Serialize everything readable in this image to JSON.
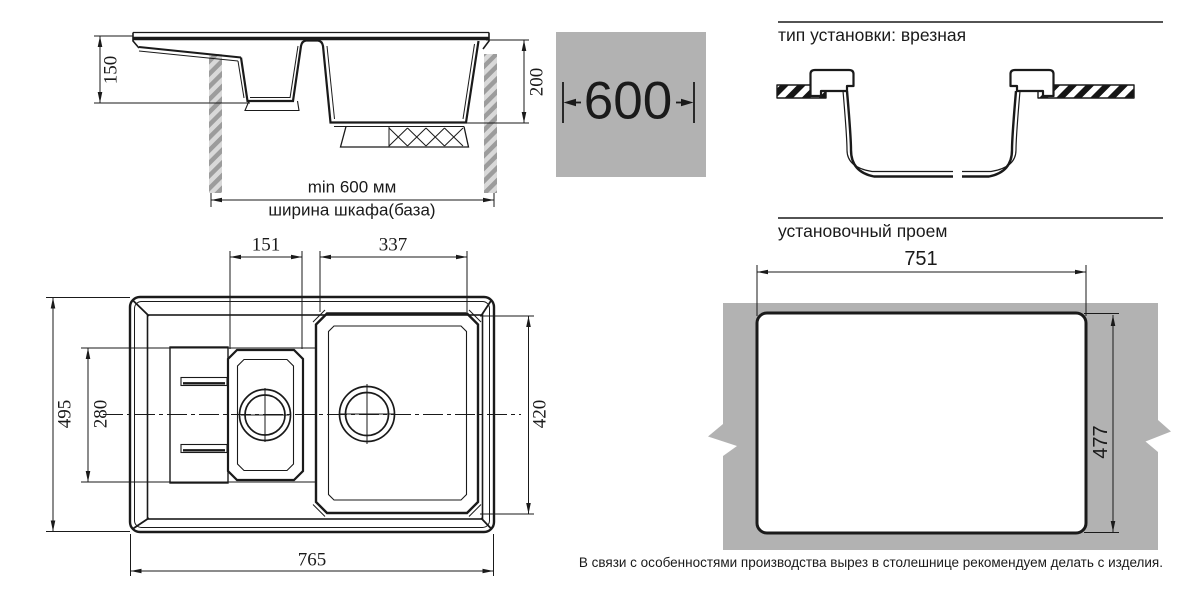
{
  "colors": {
    "line": "#1a1a1a",
    "panel_gray": "#b2b2b2"
  },
  "section_view": {
    "dim_small_bowl_depth": "150",
    "dim_large_bowl_depth": "200",
    "min_cabinet_width": "min 600 мм",
    "cabinet_width_caption": "ширина шкафа(база)"
  },
  "cabinet_badge": {
    "width_value": "600"
  },
  "installation_type": {
    "heading": "тип установки: врезная"
  },
  "cutout": {
    "heading": "установочный проем",
    "dim_width": "751",
    "dim_height": "477",
    "production_note": "В связи с особенностями производства вырез в столешнице рекомендуем делать с изделия."
  },
  "plan_view": {
    "dim_overall_length": "765",
    "dim_overall_width": "495",
    "dim_drainboard_width": "280",
    "dim_small_bowl_width": "151",
    "dim_large_bowl_width": "337",
    "dim_bowls_length": "420"
  }
}
